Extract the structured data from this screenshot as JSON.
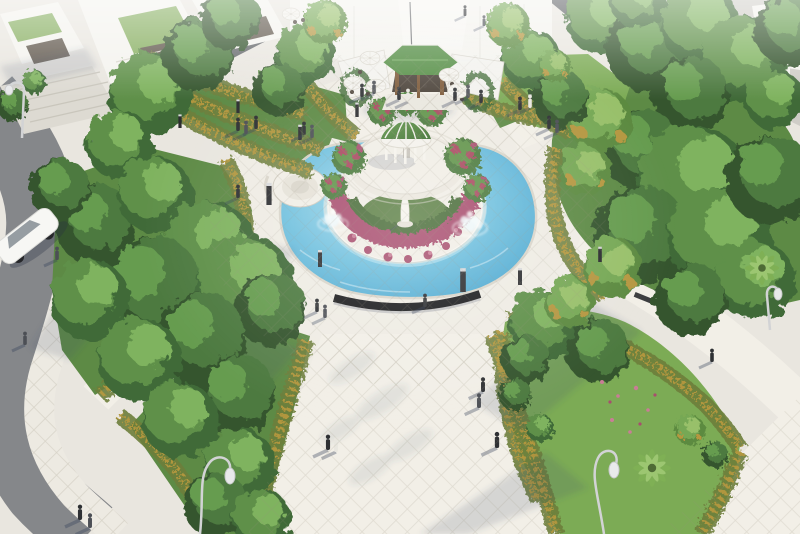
{
  "scene": {
    "view": "aerial",
    "subject": "landscaped roundabout plaza with central gazebo fountain pool, cafe pavilion, villas, trees and pedestrians",
    "counts": {
      "people": 32,
      "umbrellas": 6,
      "fountain_jets": 2,
      "street_lamps": 4,
      "bollard_lights": 10,
      "villas": 3,
      "cars": 1,
      "gazebos": 1,
      "statues": 1,
      "palm_trees": 2,
      "benches": 2
    }
  },
  "palette": {
    "pavementBase": "#e9e6df",
    "plaza": "#efece4",
    "path": "#f2efe7",
    "sidewalk": "#edeae2",
    "roadMid": "#85878a",
    "roadDark": "#64676a",
    "roadDarker": "#55585c",
    "paveShaded": "#cfcdc7",
    "buildingWhite": "#f4f3ee",
    "buildingShade": "#dddad2",
    "roofGarden": "#86ae5f",
    "windowDark": "#5f564b",
    "roofGray": "#4c4f52",
    "waterLight": "#aadcee",
    "waterMid": "#6fc0de",
    "waterDeep": "#4aa6cf",
    "poolEdge": "#b9e4f1",
    "stoneWhite": "#f1eee6",
    "stoneMid": "#e6e2d8",
    "stoneShade": "#d9d5ca",
    "lawn": "#7cab55",
    "lawnShade": "#5d8a45",
    "islandLawn": "#5d8046",
    "treeDark": "#3f6b38",
    "treeMid": "#5e9049",
    "treeLight": "#7fb35e",
    "treeDeep": "#35552e",
    "treeMid2": "#4e7a40",
    "treeLight2": "#669c50",
    "treeTintD": "#5c8a3f",
    "treeTint": "#76a854",
    "treeTintL": "#98c06b",
    "hedgeGold": "#b5973f",
    "hedgeOlive": "#6d7f3a",
    "flowerMagenta": "#a84e6e",
    "flowerPink": "#c97d96",
    "flowerRed": "#a8485f",
    "domeLight": "#63984a",
    "domeDark": "#3c6e2f",
    "roofGreen": "#4e8a3e",
    "roofGreenL": "#6fa85c",
    "woodBrown": "#7a5634",
    "interiorDark": "#463d34",
    "canvasWhite": "#f3f2ee",
    "umbrellaWhite": "#f4f3ee",
    "furnitureDark": "#4a4139",
    "carWhite": "#f7f7f4",
    "carWindow": "#8b9299",
    "metalDark": "#2c2d30",
    "bollardCap": "#d8d9db",
    "lampGray": "#d2d3d5",
    "peopleDark": "#2e3033",
    "peopleMid": "#4c4f55",
    "peopleLight": "#e9e7e0",
    "statueWhite": "#f5f3ec",
    "benchDark": "#3b3c3e",
    "wallBlack": "#1a1b1d",
    "shadow": "rgba(70,80,108,0.16)"
  }
}
